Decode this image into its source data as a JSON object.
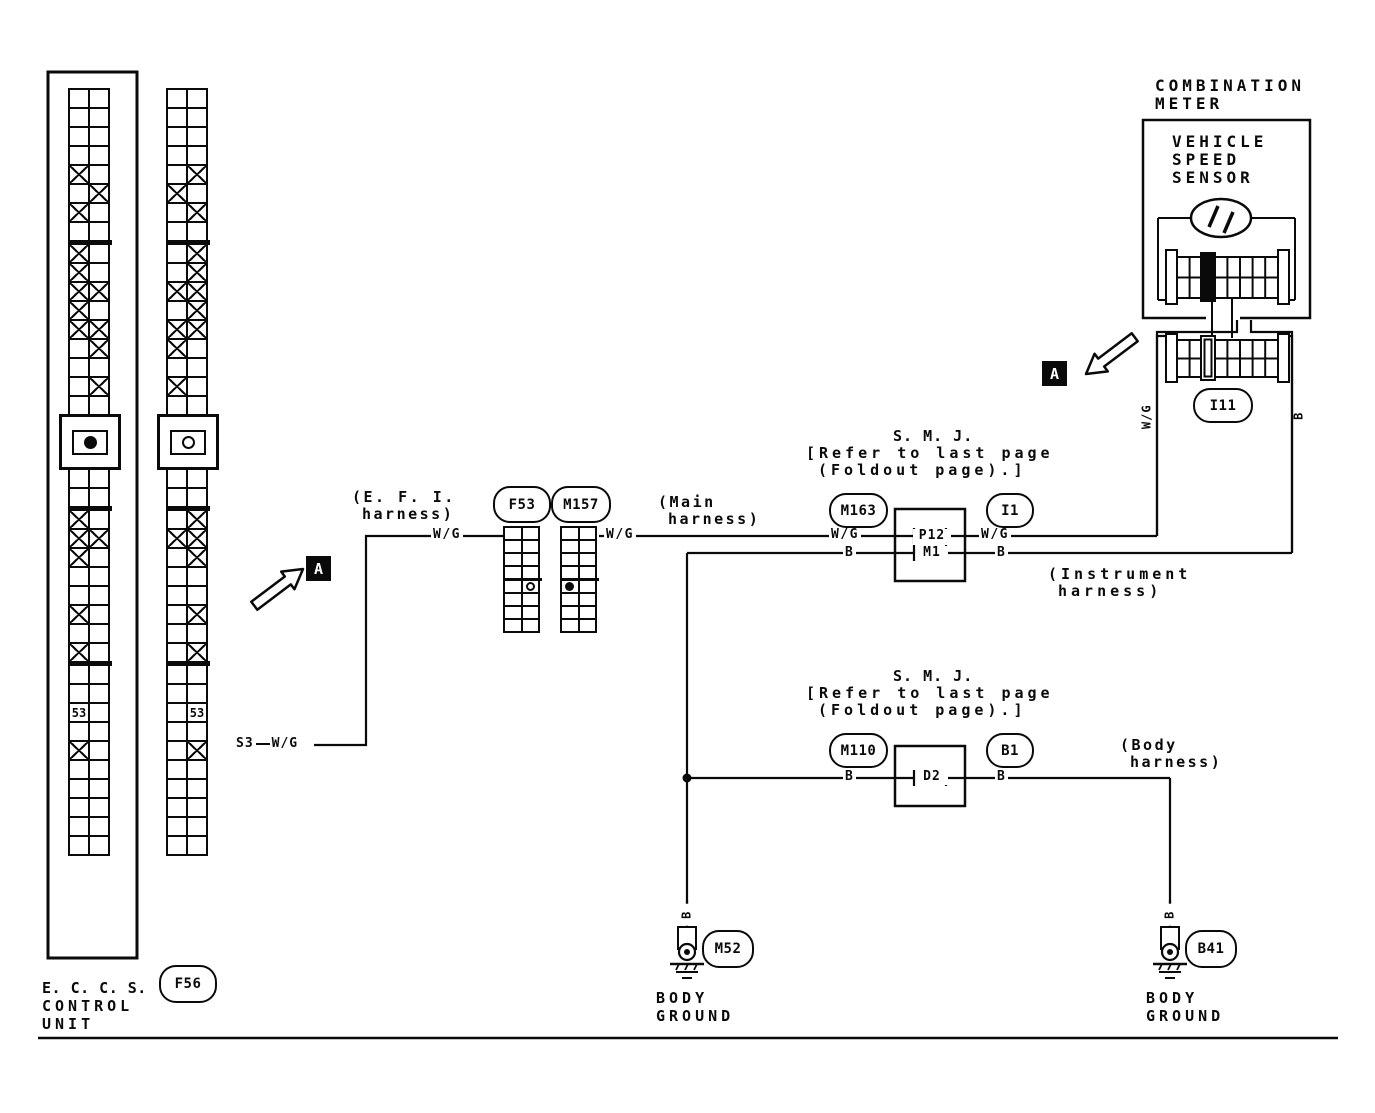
{
  "meter": {
    "title1": "COMBINATION",
    "title2": "METER",
    "sensor1": "VEHICLE",
    "sensor2": "SPEED",
    "sensor3": "SENSOR",
    "connector": "I11"
  },
  "marker_a": "A",
  "wire": {
    "wg": "W/G",
    "b": "B",
    "s3": "S3"
  },
  "harness": {
    "efi1": "(E. F. I.",
    "efi2": "harness)",
    "main1": "(Main",
    "main2": "harness)",
    "inst1": "(Instrument",
    "inst2": "harness)",
    "body1": "(Body",
    "body2": "harness)"
  },
  "smj": {
    "title": "S. M. J.",
    "note1": "[Refer to last page",
    "note2": "(Foldout page).]",
    "upper_left": "M163",
    "upper_right": "I1",
    "upper_pin_top": "P12",
    "upper_pin_bottom": "M1",
    "lower_left": "M110",
    "lower_right": "B1",
    "lower_pin": "D2"
  },
  "eccs": {
    "label1": "E. C. C. S.",
    "label2": "CONTROL",
    "label3": "UNIT",
    "connector": "F56"
  },
  "connectors": {
    "f53": "F53",
    "m157": "M157",
    "m52": "M52",
    "b41": "B41"
  },
  "ground": {
    "line1": "BODY",
    "line2": "GROUND"
  },
  "grids": {
    "cell_label": "53",
    "eccs_left": {
      "rows": [
        "..",
        "..",
        "..",
        "..",
        "X.",
        ".X",
        "X.",
        "..",
        "SEP",
        "X.",
        "X.",
        "XX",
        "X.",
        "XX",
        ".X",
        "..",
        ".X",
        "..",
        "DOT",
        "..",
        "..",
        "SEP",
        "X.",
        "XX",
        "X.",
        "..",
        "..",
        "X.",
        "..",
        "X.",
        "SEP",
        "..",
        "..",
        "L.",
        "..",
        "X.",
        "..",
        "..",
        "..",
        "..",
        ".."
      ]
    },
    "eccs_right": {
      "rows": [
        "..",
        "..",
        "..",
        "..",
        ".X",
        "X.",
        ".X",
        "..",
        "SEP",
        ".X",
        ".X",
        "XX",
        ".X",
        "XX",
        "X.",
        "..",
        "X.",
        "..",
        "RING",
        "..",
        "..",
        "SEP",
        ".X",
        "XX",
        ".X",
        "..",
        "..",
        ".X",
        "..",
        ".X",
        "SEP",
        "..",
        "..",
        ".L",
        "..",
        ".X",
        "..",
        "..",
        "..",
        "..",
        ".."
      ]
    },
    "f53": {
      "rows": [
        "..",
        "..",
        "..",
        "..",
        "SEP",
        ".O",
        "..",
        "..",
        ".."
      ]
    },
    "m157": {
      "rows": [
        "..",
        "..",
        "..",
        "..",
        "SEP",
        "*.",
        "..",
        "..",
        ".."
      ]
    }
  }
}
